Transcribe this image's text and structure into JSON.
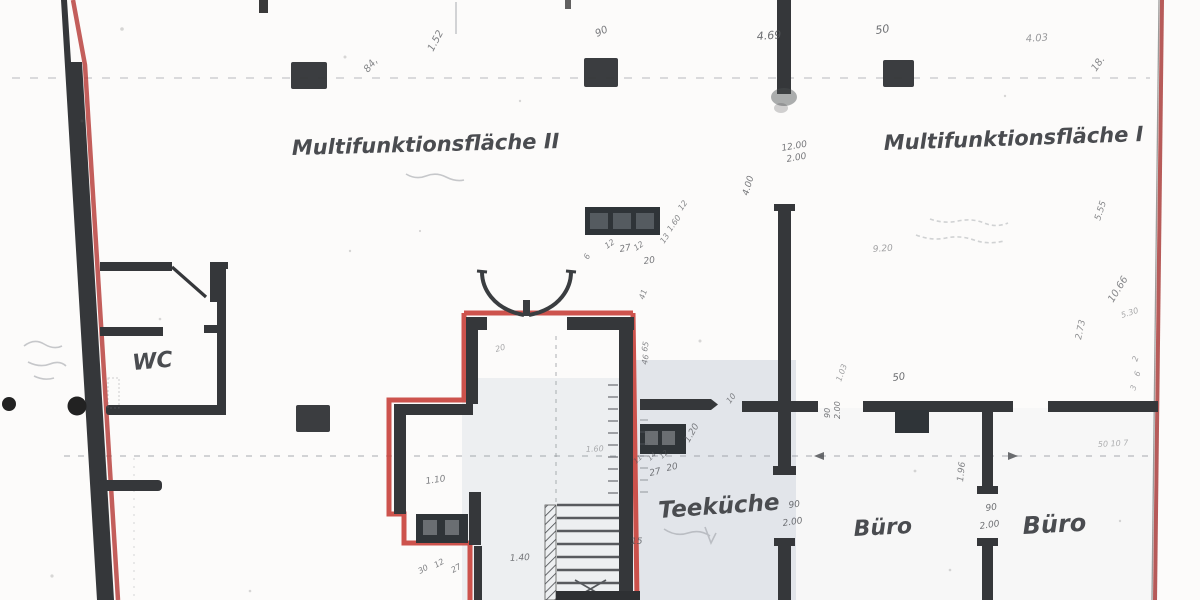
{
  "rooms": {
    "multifunktionsflaeche_2": {
      "label": "Multifunktionsfläche II"
    },
    "multifunktionsflaeche_1": {
      "label": "Multifunktionsfläche I"
    },
    "wc": {
      "label": "WC"
    },
    "teekueche": {
      "label": "Teeküche"
    },
    "buero_links": {
      "label": "Büro"
    },
    "buero_rechts": {
      "label": "Büro"
    }
  },
  "colors": {
    "red_line": "#c8403a",
    "wall": "#35373a",
    "pencil": "#54565a",
    "tint": "#ccd3dc"
  },
  "dimensions": [
    {
      "name": "dim-90-top",
      "text": "90",
      "x": 597,
      "y": 37,
      "rot": -25,
      "size": 10,
      "op": 0.8
    },
    {
      "name": "dim-1-52",
      "text": "1.52",
      "x": 433,
      "y": 52,
      "rot": -62,
      "size": 10,
      "op": 0.75
    },
    {
      "name": "dim-84",
      "text": "84,",
      "x": 368,
      "y": 73,
      "rot": -50,
      "size": 10,
      "op": 0.7
    },
    {
      "name": "dim-4-69",
      "text": "4.69",
      "x": 757,
      "y": 40,
      "rot": -4,
      "size": 11,
      "op": 0.85
    },
    {
      "name": "dim-50-top",
      "text": "50",
      "x": 876,
      "y": 34,
      "rot": -8,
      "size": 11,
      "op": 0.85
    },
    {
      "name": "dim-4-03",
      "text": "4.03",
      "x": 1026,
      "y": 42,
      "rot": -4,
      "size": 10,
      "op": 0.6
    },
    {
      "name": "dim-18",
      "text": "18.",
      "x": 1096,
      "y": 72,
      "rot": -55,
      "size": 10,
      "op": 0.7
    },
    {
      "name": "dim-12-00",
      "text": "12.00",
      "x": 782,
      "y": 151,
      "rot": -10,
      "size": 9,
      "op": 0.8
    },
    {
      "name": "dim-2-00-a",
      "text": "2.00",
      "x": 787,
      "y": 162,
      "rot": -10,
      "size": 9,
      "op": 0.8
    },
    {
      "name": "dim-4-00",
      "text": "4.00",
      "x": 748,
      "y": 196,
      "rot": -74,
      "size": 9,
      "op": 0.8
    },
    {
      "name": "dim-9-20",
      "text": "9.20",
      "x": 873,
      "y": 252,
      "rot": -4,
      "size": 9,
      "op": 0.55
    },
    {
      "name": "dim-5-55",
      "text": "5.55",
      "x": 1100,
      "y": 221,
      "rot": -72,
      "size": 9,
      "op": 0.7
    },
    {
      "name": "dim-10-66",
      "text": "10.66",
      "x": 1113,
      "y": 303,
      "rot": -58,
      "size": 10,
      "op": 0.7
    },
    {
      "name": "dim-5-30",
      "text": "5.30",
      "x": 1122,
      "y": 318,
      "rot": -18,
      "size": 8,
      "op": 0.5
    },
    {
      "name": "dim-2-73",
      "text": "2.73",
      "x": 1081,
      "y": 340,
      "rot": -78,
      "size": 9,
      "op": 0.65
    },
    {
      "name": "dim-1-03",
      "text": "1.03",
      "x": 841,
      "y": 382,
      "rot": -70,
      "size": 8,
      "op": 0.55
    },
    {
      "name": "dim-50-mid",
      "text": "50",
      "x": 893,
      "y": 381,
      "rot": -8,
      "size": 10,
      "op": 0.85
    },
    {
      "name": "dim-90-rot",
      "text": "90",
      "x": 830,
      "y": 418,
      "rot": -90,
      "size": 8,
      "op": 0.8
    },
    {
      "name": "dim-2-00-rot",
      "text": "2.00",
      "x": 840,
      "y": 419,
      "rot": -90,
      "size": 8,
      "op": 0.8
    },
    {
      "name": "dim-90-door-mitte",
      "text": "90",
      "x": 789,
      "y": 508,
      "rot": -8,
      "size": 9,
      "op": 0.85
    },
    {
      "name": "dim-2-00-door-mitte",
      "text": "2.00",
      "x": 783,
      "y": 526,
      "rot": -8,
      "size": 9,
      "op": 0.85
    },
    {
      "name": "dim-90-door-rechts",
      "text": "90",
      "x": 986,
      "y": 511,
      "rot": -8,
      "size": 9,
      "op": 0.85
    },
    {
      "name": "dim-2-00-door-rechts",
      "text": "2.00",
      "x": 980,
      "y": 529,
      "rot": -8,
      "size": 9,
      "op": 0.85
    },
    {
      "name": "dim-1-96",
      "text": "1.96",
      "x": 963,
      "y": 482,
      "rot": -84,
      "size": 9,
      "op": 0.7
    },
    {
      "name": "dim-2-col",
      "text": "2",
      "x": 1137,
      "y": 362,
      "rot": -70,
      "size": 8,
      "op": 0.55
    },
    {
      "name": "dim-6-col",
      "text": "6",
      "x": 1139,
      "y": 377,
      "rot": -70,
      "size": 8,
      "op": 0.55
    },
    {
      "name": "dim-3-col",
      "text": "3",
      "x": 1135,
      "y": 391,
      "rot": -70,
      "size": 8,
      "op": 0.5
    },
    {
      "name": "dim-50-10-7",
      "text": "50 10 7",
      "x": 1098,
      "y": 447,
      "rot": -3,
      "size": 8,
      "op": 0.45
    },
    {
      "name": "dim-27-tk",
      "text": "27",
      "x": 650,
      "y": 476,
      "rot": -12,
      "size": 9,
      "op": 0.8
    },
    {
      "name": "dim-20-tk",
      "text": "20",
      "x": 667,
      "y": 471,
      "rot": -12,
      "size": 9,
      "op": 0.8
    },
    {
      "name": "dim-11-tk",
      "text": "11",
      "x": 636,
      "y": 464,
      "rot": -42,
      "size": 7,
      "op": 0.7
    },
    {
      "name": "dim-14-tk",
      "text": "14",
      "x": 650,
      "y": 461,
      "rot": -42,
      "size": 7,
      "op": 0.7
    },
    {
      "name": "dim-12-tk",
      "text": "12",
      "x": 662,
      "y": 459,
      "rot": -42,
      "size": 7,
      "op": 0.7
    },
    {
      "name": "dim-1-20",
      "text": "1.20",
      "x": 689,
      "y": 443,
      "rot": -60,
      "size": 9,
      "op": 0.75
    },
    {
      "name": "dim-10-tk",
      "text": "10",
      "x": 730,
      "y": 404,
      "rot": -52,
      "size": 8,
      "op": 0.7
    },
    {
      "name": "dim-12-block-a",
      "text": "12",
      "x": 607,
      "y": 249,
      "rot": -35,
      "size": 8,
      "op": 0.75
    },
    {
      "name": "dim-27-block",
      "text": "27",
      "x": 620,
      "y": 252,
      "rot": -10,
      "size": 9,
      "op": 0.8
    },
    {
      "name": "dim-12-block-b",
      "text": "12",
      "x": 636,
      "y": 251,
      "rot": -35,
      "size": 8,
      "op": 0.75
    },
    {
      "name": "dim-20-block",
      "text": "20",
      "x": 644,
      "y": 264,
      "rot": -8,
      "size": 9,
      "op": 0.8
    },
    {
      "name": "dim-6-block",
      "text": "6",
      "x": 588,
      "y": 260,
      "rot": -60,
      "size": 8,
      "op": 0.7
    },
    {
      "name": "dim-13-diag",
      "text": "13",
      "x": 664,
      "y": 244,
      "rot": -55,
      "size": 8,
      "op": 0.7
    },
    {
      "name": "dim-1-60-diag",
      "text": "1.60",
      "x": 671,
      "y": 232,
      "rot": -55,
      "size": 8,
      "op": 0.7
    },
    {
      "name": "dim-12-diag",
      "text": "12",
      "x": 682,
      "y": 211,
      "rot": -55,
      "size": 8,
      "op": 0.7
    },
    {
      "name": "dim-41",
      "text": "41",
      "x": 644,
      "y": 300,
      "rot": -72,
      "size": 8,
      "op": 0.7
    },
    {
      "name": "dim-65",
      "text": "65",
      "x": 647,
      "y": 352,
      "rot": -80,
      "size": 8,
      "op": 0.7
    },
    {
      "name": "dim-46",
      "text": "46",
      "x": 647,
      "y": 365,
      "rot": -80,
      "size": 8,
      "op": 0.7
    },
    {
      "name": "dim-20-vestibule",
      "text": "20",
      "x": 496,
      "y": 352,
      "rot": -15,
      "size": 8,
      "op": 0.5
    },
    {
      "name": "dim-1-10",
      "text": "1.10",
      "x": 426,
      "y": 484,
      "rot": -8,
      "size": 9,
      "op": 0.75
    },
    {
      "name": "dim-30-s",
      "text": "30",
      "x": 420,
      "y": 574,
      "rot": -30,
      "size": 8,
      "op": 0.75
    },
    {
      "name": "dim-12-s",
      "text": "12",
      "x": 436,
      "y": 568,
      "rot": -30,
      "size": 8,
      "op": 0.75
    },
    {
      "name": "dim-27-s",
      "text": "27",
      "x": 453,
      "y": 573,
      "rot": -30,
      "size": 8,
      "op": 0.75
    },
    {
      "name": "dim-1-40",
      "text": "1.40",
      "x": 510,
      "y": 561,
      "rot": -3,
      "size": 9,
      "op": 0.8
    },
    {
      "name": "dim-15",
      "text": "15",
      "x": 631,
      "y": 544,
      "rot": 0,
      "size": 9,
      "op": 0.8
    },
    {
      "name": "dim-1-60-faint",
      "text": "1.60",
      "x": 586,
      "y": 452,
      "rot": -3,
      "size": 8,
      "op": 0.45
    }
  ]
}
